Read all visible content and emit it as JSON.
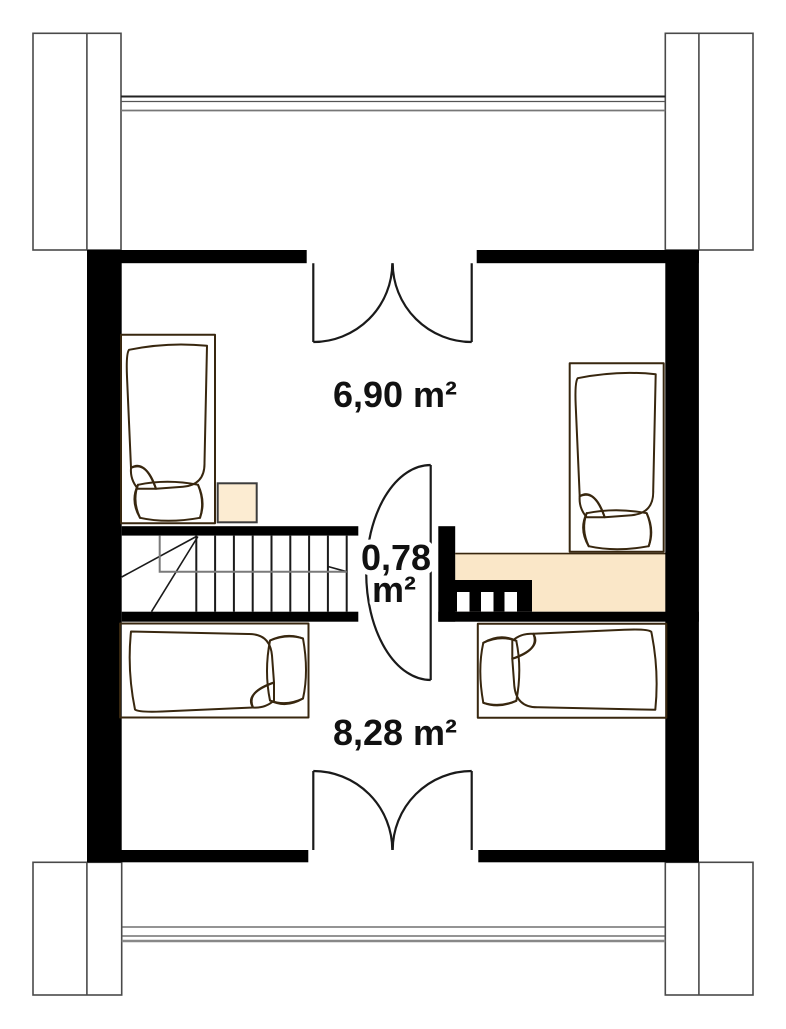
{
  "plan": {
    "type": "attic-floor-plan",
    "rooms": {
      "bedroom_top": {
        "name": "upper bedroom",
        "area_label": "6,90 m²"
      },
      "landing": {
        "name": "stair landing",
        "area_label_line1": "0,78",
        "area_label_line2": "m²"
      },
      "bedroom_bottom": {
        "name": "lower bedroom",
        "area_label": "8,28 m²"
      }
    },
    "objects": {
      "beds": [
        "bed-top-left",
        "bed-top-right",
        "bed-bottom-left",
        "bed-bottom-right"
      ],
      "stairs": "u-shaped staircase with break lines",
      "railing": "stair railing with balusters",
      "wardrobe": "low wardrobe strip along right wall",
      "nightstand": "small square nightstand",
      "doors": [
        "double-swing-door-top",
        "double-swing-door-bottom",
        "landing-door-arc"
      ],
      "chimneys": [
        "column-top-left",
        "column-top-right",
        "column-bottom-left",
        "column-bottom-right"
      ]
    },
    "colors": {
      "wall": "#000000",
      "bed_fill": "#f8d6a2",
      "bed_outline": "#38270f",
      "wardrobe_fill": "#fae7c8",
      "nightstand_fill": "#fcecd2",
      "line_dark": "#1a1a1a",
      "line_gray": "#777777",
      "text": "#111111",
      "background": "#ffffff"
    }
  }
}
